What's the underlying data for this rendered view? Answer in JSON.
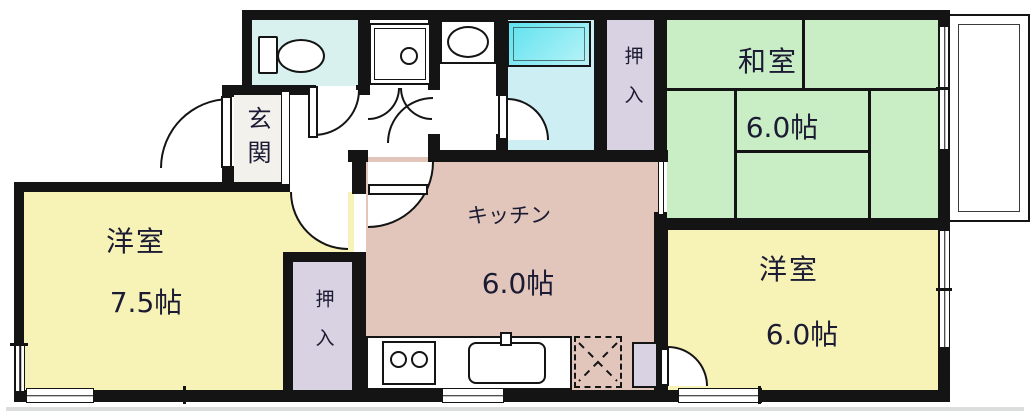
{
  "rooms": {
    "washitsu": {
      "label": "和室",
      "area": "6.0帖"
    },
    "western_left": {
      "label": "洋室",
      "area": "7.5帖"
    },
    "western_right": {
      "label": "洋室",
      "area": "6.0帖"
    },
    "kitchen": {
      "label": "キッチン",
      "area": "6.0帖"
    },
    "entrance": {
      "label": "玄関"
    },
    "closet_top": {
      "label": "押入"
    },
    "closet_bottom": {
      "label": "押入"
    }
  },
  "colors": {
    "wall": "#141414",
    "text": "#1b1b33",
    "tatami": "#c9edc5",
    "room_yellow": "#f7f3b7",
    "kitchen_pink": "#e2c6bb",
    "closet_lavender": "#d9d2e2",
    "toilet_floor": "#d8f0ee",
    "bath_floor": "#cdeff3",
    "tub_fill": "#5fe2ee",
    "genkan_floor": "#f3f1ec"
  }
}
